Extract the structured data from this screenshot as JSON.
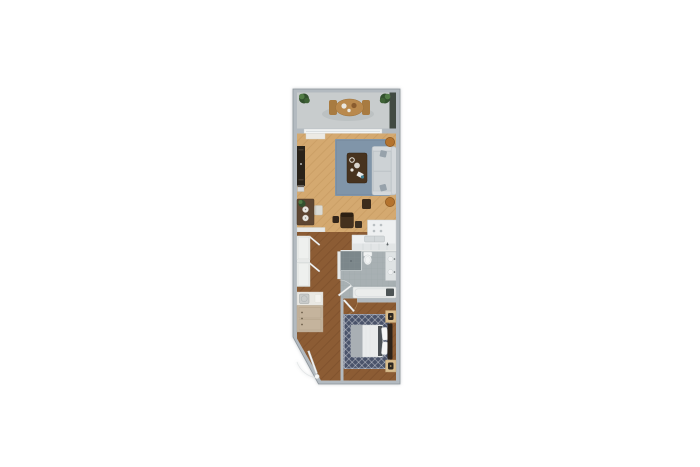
{
  "page": {
    "background": "#ffffff",
    "description": "Top-down 3D rendered floor plan of a narrow one-bedroom apartment, centered on a plain white background. No text is rendered in the image."
  },
  "palette": {
    "wall": "#b3bac0",
    "balcony_floor": "#c8cccd",
    "balcony_shadow": "#b6bcbe",
    "window_band": "#414a42",
    "slider": "#f2f4f4",
    "bench": "#eceae4",
    "wood_light": "#d4a970",
    "wood_dark": "#8c5c34",
    "partition": "#e7e9e8",
    "rug_living": "#8095a9",
    "sofa": "#c8cdd1",
    "sofa_back": "#d4d8db",
    "sofa_pillow": "#97a2ab",
    "side_stool": "#b4732e",
    "coffee_table": "#47331f",
    "tv_console": "#292219",
    "bistro_table": "#5e4632",
    "chair_white": "#dbdbd5",
    "chair_dark": "#44311e",
    "plate": "#e9e7e1",
    "plant_dark": "#33512e",
    "plant_light": "#527c46",
    "patio_table": "#b9894d",
    "patio_chair": "#a87b41",
    "counter": "#eef0f1",
    "counter_face": "#e2e5e6",
    "sink": "#d3d8da",
    "tile": "#a8b0b3",
    "shower": "#7c878b",
    "porcelain": "#f1f3f3",
    "vanity": "#dfe3e4",
    "tub": "#ebedec",
    "fixture_dark": "#3c4246",
    "closet": "#eef0ee",
    "door": "#f4f5f5",
    "unit_top": "#e9e8e3",
    "unit_body": "#c5b49d",
    "rug_bedroom": "#4a536a",
    "mattress": "#e9ebec",
    "blanket": "#a9afb4",
    "pillow": "#f5f6f6",
    "bed_dark": "#3a3f45",
    "headboard": "#2d231a",
    "nightstand": "#d9bd8d",
    "lamp": "#2b2722",
    "knob": "#6d5f4b"
  },
  "plan": {
    "rooms": [
      {
        "id": "balcony",
        "furniture": [
          "corner-plant-left",
          "corner-plant-right",
          "patio-table",
          "patio-chairs",
          "dark-window-band"
        ]
      },
      {
        "id": "living-room",
        "furniture": [
          "sliding-glass-door",
          "tv-console",
          "area-rug",
          "coffee-table",
          "sofa",
          "side-stools",
          "bistro-table",
          "white-chair",
          "dark-chairs"
        ]
      },
      {
        "id": "kitchen",
        "furniture": [
          "l-shaped-counter",
          "sink",
          "faucet",
          "cabinet-faces"
        ]
      },
      {
        "id": "hallway",
        "furniture": [
          "closet-upper",
          "closet-lower",
          "open-closet-doors"
        ]
      },
      {
        "id": "bathroom",
        "furniture": [
          "shower",
          "toilet",
          "vanity",
          "bathtub",
          "bathroom-door"
        ]
      },
      {
        "id": "bedroom",
        "furniture": [
          "patterned-rug",
          "double-bed",
          "headboard",
          "nightstand-with-lamp-top",
          "nightstand-with-lamp-bottom",
          "bedroom-door"
        ]
      },
      {
        "id": "entry",
        "furniture": [
          "laundry-storage-unit",
          "entry-door-with-swing"
        ]
      }
    ]
  }
}
